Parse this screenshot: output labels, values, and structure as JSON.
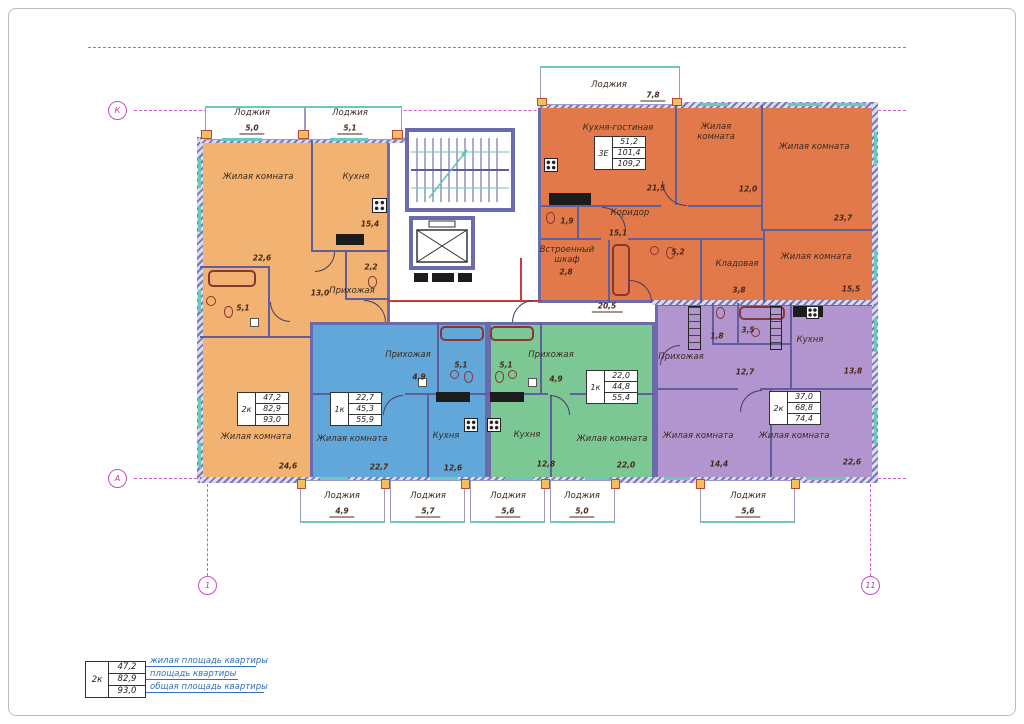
{
  "axis_markers": {
    "row_top": "К",
    "row_bottom": "А",
    "col_left": "1",
    "col_right": "11"
  },
  "common": {
    "corridor_dim": "20,5"
  },
  "legend": {
    "type": "2к",
    "living": "47,2",
    "area": "82,9",
    "total": "93,0",
    "label_living": "жилая площадь квартиры",
    "label_area": "площадь квартиры",
    "label_total": "общая площадь квартиры"
  },
  "apartments": {
    "orange": {
      "type": "2к",
      "living": "47,2",
      "area": "82,9",
      "total": "93,0",
      "rooms": {
        "living1": {
          "name": "Жилая комната",
          "area": "22,6"
        },
        "kitchen": {
          "name": "Кухня",
          "area": "15,4"
        },
        "hall": {
          "name": "Прихожая",
          "area": "13,0"
        },
        "bath": {
          "area": "5,1"
        },
        "wc": {
          "area": "2,2"
        },
        "living2": {
          "name": "Жилая комната",
          "area": "24,6"
        },
        "loggia1": {
          "name": "Лоджия",
          "area": "5,0"
        },
        "loggia2": {
          "name": "Лоджия",
          "area": "5,1"
        }
      }
    },
    "threeE": {
      "type": "3Е",
      "living": "51,2",
      "area": "101,4",
      "total": "109,2",
      "rooms": {
        "kitchen_living": {
          "name": "Кухня-гостиная",
          "area": "21,5"
        },
        "living1": {
          "name": "Жилая комната",
          "area": "12,0"
        },
        "living2": {
          "name": "Жилая комната",
          "area": "23,7"
        },
        "living3": {
          "name": "Жилая комната",
          "area": "15,5"
        },
        "corridor": {
          "name": "Коридор",
          "area": "15,1"
        },
        "wardrobe": {
          "name": "Встроенный шкаф",
          "area": "2,8"
        },
        "pantry": {
          "name": "Кладовая",
          "area": "3,8"
        },
        "bath": {
          "area": "5,2"
        },
        "wc": {
          "area": "1,9"
        },
        "loggia": {
          "name": "Лоджия",
          "area": "7,8"
        }
      }
    },
    "blue": {
      "type": "1к",
      "living": "22,7",
      "area": "45,3",
      "total": "55,9",
      "rooms": {
        "living1": {
          "name": "Жилая комната",
          "area": "22,7"
        },
        "kitchen": {
          "name": "Кухня",
          "area": "12,6"
        },
        "hall": {
          "name": "Прихожая",
          "area": "4,9"
        },
        "bath": {
          "area": "5,1"
        },
        "loggia1": {
          "name": "Лоджия",
          "area": "4,9"
        },
        "loggia2": {
          "name": "Лоджия",
          "area": "5,7"
        }
      }
    },
    "green": {
      "type": "1к",
      "living": "22,0",
      "area": "44,8",
      "total": "55,4",
      "rooms": {
        "living1": {
          "name": "Жилая комната",
          "area": "22,0"
        },
        "kitchen": {
          "name": "Кухня",
          "area": "12,8"
        },
        "hall": {
          "name": "Прихожая",
          "area": "4,9"
        },
        "bath": {
          "area": "5,1"
        },
        "loggia1": {
          "name": "Лоджия",
          "area": "5,6"
        },
        "loggia2": {
          "name": "Лоджия",
          "area": "5,0"
        }
      }
    },
    "purple": {
      "type": "2к",
      "living": "37,0",
      "area": "68,8",
      "total": "74,4",
      "rooms": {
        "living1": {
          "name": "Жилая комната",
          "area": "14,4"
        },
        "living2": {
          "name": "Жилая комната",
          "area": "22,6"
        },
        "kitchen": {
          "name": "Кухня",
          "area": "13,8"
        },
        "hall": {
          "name": "Прихожая",
          "area": "12,7"
        },
        "bath": {
          "area": "3,5"
        },
        "wc": {
          "area": "1,8"
        },
        "loggia": {
          "name": "Лоджия",
          "area": "5,6"
        }
      }
    }
  }
}
